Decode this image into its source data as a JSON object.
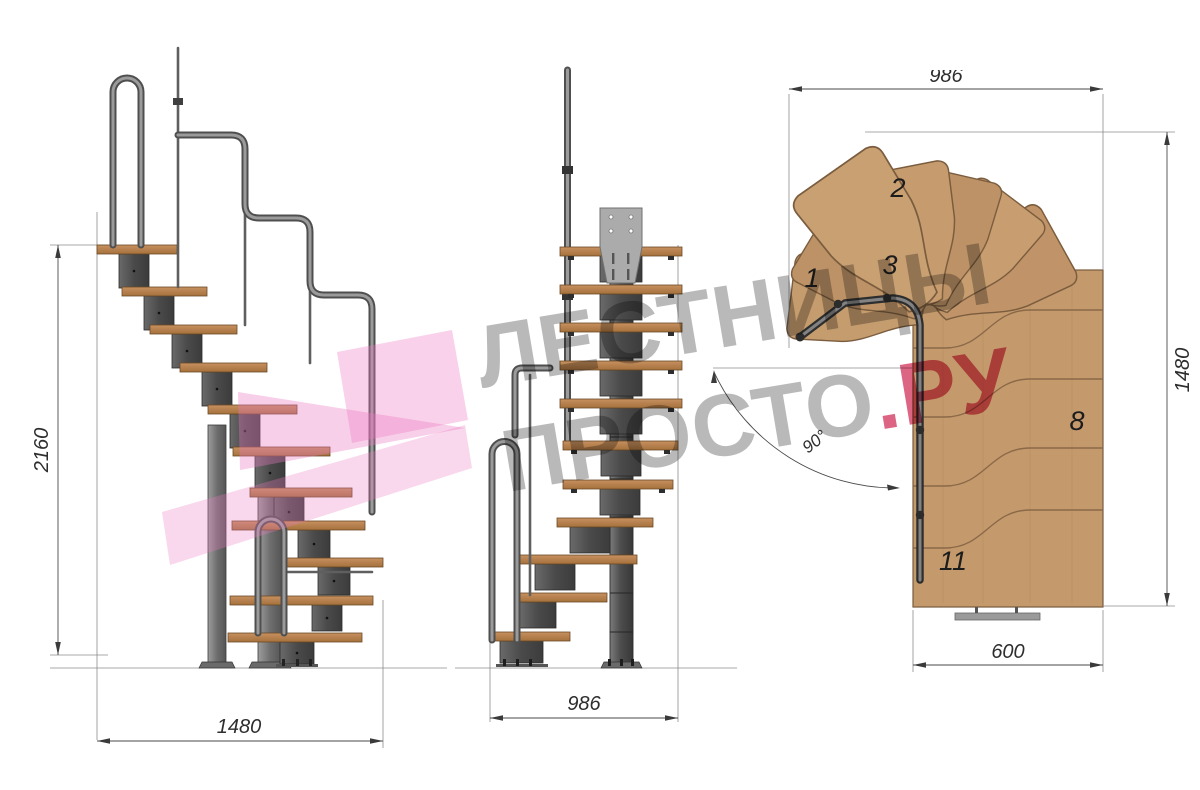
{
  "page": {
    "background": "#ffffff",
    "description": "Modular staircase technical drawing with three views"
  },
  "watermark": {
    "line1": "ЛЕСТНИЦЫ",
    "line2_gray": "ПРОСТО",
    "line2_accent": ".РУ",
    "gray_color": "#808080",
    "accent_color": "#d33e65"
  },
  "logo": {
    "color": "#ec79c1"
  },
  "side_view": {
    "dim_height": "2160",
    "dim_length": "1480"
  },
  "front_view": {
    "dim_width": "986"
  },
  "plan_view": {
    "dim_top": "986",
    "dim_right": "1480",
    "dim_bottom": "600",
    "angle_label": "90°",
    "step_labels": {
      "s1": "1",
      "s2": "2",
      "s3": "3",
      "s8": "8",
      "s11": "11"
    }
  },
  "colors": {
    "wood": "#c49a6c",
    "wood_edge": "#8a6848",
    "steel_dark": "#4c4c4c",
    "steel_light": "#a0a0a0",
    "rail": "#8f8f8f",
    "dimension": "#3a3a3a"
  }
}
